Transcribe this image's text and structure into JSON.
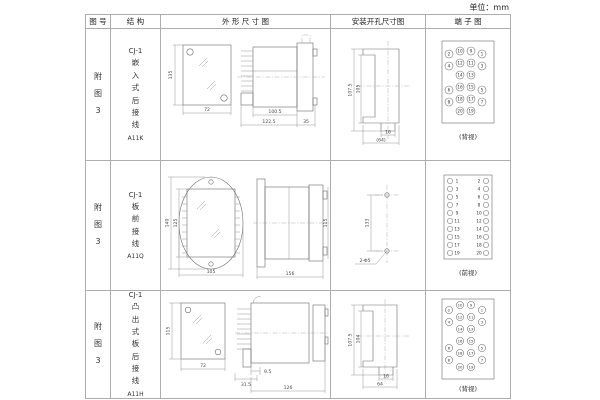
{
  "page": {
    "unit_label": "单位：mm"
  },
  "table": {
    "headers": {
      "fig_no": "图 号",
      "structure": "结 构",
      "outline": "外 形 尺 寸 图",
      "install": "安装开孔尺寸图",
      "terminal": "端 子 图"
    },
    "rows": [
      {
        "fig_no": "附图3",
        "structure": {
          "model": "CJ-1",
          "desc": "嵌入式后接线",
          "code": "A11K"
        },
        "outline": {
          "front_h": "135",
          "front_w": "72",
          "d1": "100.5",
          "d2": "122.5",
          "d3": "35"
        },
        "install": {
          "v1": "107.5",
          "v2": "105",
          "h1": "16",
          "h2": "(64)"
        },
        "terminal": {
          "view": "(背视)",
          "numbers": [
            2,
            10,
            9,
            1,
            4,
            12,
            11,
            3,
            14,
            13,
            6,
            16,
            15,
            5,
            8,
            18,
            17,
            7,
            20,
            19
          ]
        }
      },
      {
        "fig_no": "附图3",
        "structure": {
          "model": "CJ-1",
          "desc": "板前接线",
          "code": "A11Q"
        },
        "outline": {
          "front_h1": "140",
          "front_h2": "125",
          "front_w": "105",
          "side_w": "156",
          "side_h": "115"
        },
        "install": {
          "v1": "133",
          "holes": "2-Φ5"
        },
        "terminal": {
          "view": "(前视)",
          "numbers": [
            1,
            2,
            3,
            4,
            5,
            6,
            7,
            8,
            9,
            10,
            11,
            12,
            13,
            14,
            15,
            16,
            17,
            18,
            19,
            20
          ]
        }
      },
      {
        "fig_no": "附图3",
        "structure": {
          "model": "CJ-1",
          "desc": "凸出式板后接线",
          "code": "A11H"
        },
        "outline": {
          "front_h": "115",
          "front_w": "72",
          "d1": "31.5",
          "d2": "9.5",
          "d3": "126"
        },
        "install": {
          "v1": "107.5",
          "v2": "104",
          "h1": "16",
          "h2": "64"
        },
        "terminal": {
          "view": "(背视)",
          "numbers": [
            2,
            10,
            9,
            1,
            4,
            12,
            11,
            3,
            14,
            13,
            6,
            16,
            15,
            5,
            8,
            18,
            17,
            7,
            20,
            19
          ]
        }
      }
    ]
  }
}
